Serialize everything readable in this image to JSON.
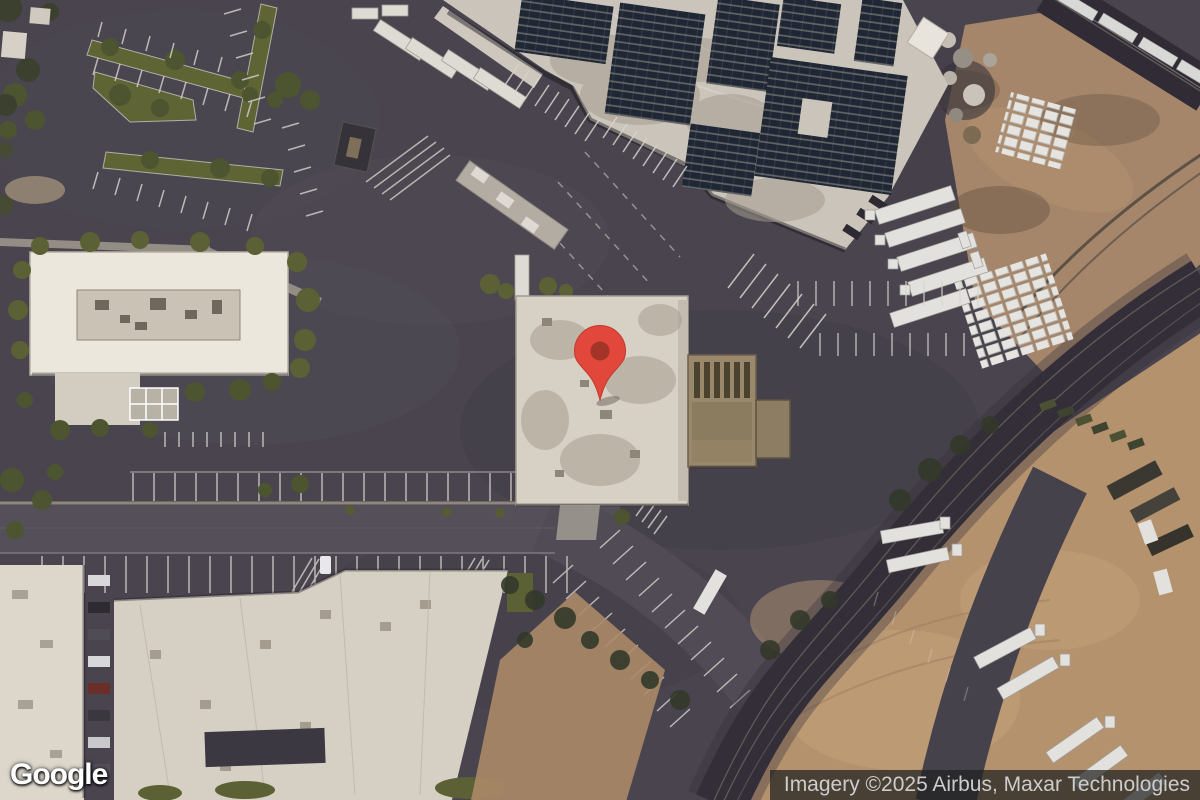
{
  "map": {
    "view_type": "satellite",
    "marker": {
      "name": "location-pin",
      "fill": "#E2473B",
      "stroke": "#C03A2C",
      "dot": "#A23528",
      "tip_x": 600,
      "tip_y": 400
    }
  },
  "branding": {
    "logo_text": "Google"
  },
  "attribution": {
    "text": "Imagery ©2025 Airbus, Maxar Technologies",
    "text_color": "#CCCCCC",
    "background": "#202020"
  },
  "palette": {
    "asphalt": "#49444E",
    "road": "#544F59",
    "roof_light": "#CFC8BE",
    "roof_white": "#E6E1D7",
    "solar_panel": "#1F2734",
    "vegetation": "#5C6135",
    "dirt": "#A8865F",
    "dirt_lot": "#B5926E",
    "railroad": "#37323B",
    "truck_white": "#E2E1DD",
    "tan_building": "#99886C"
  }
}
